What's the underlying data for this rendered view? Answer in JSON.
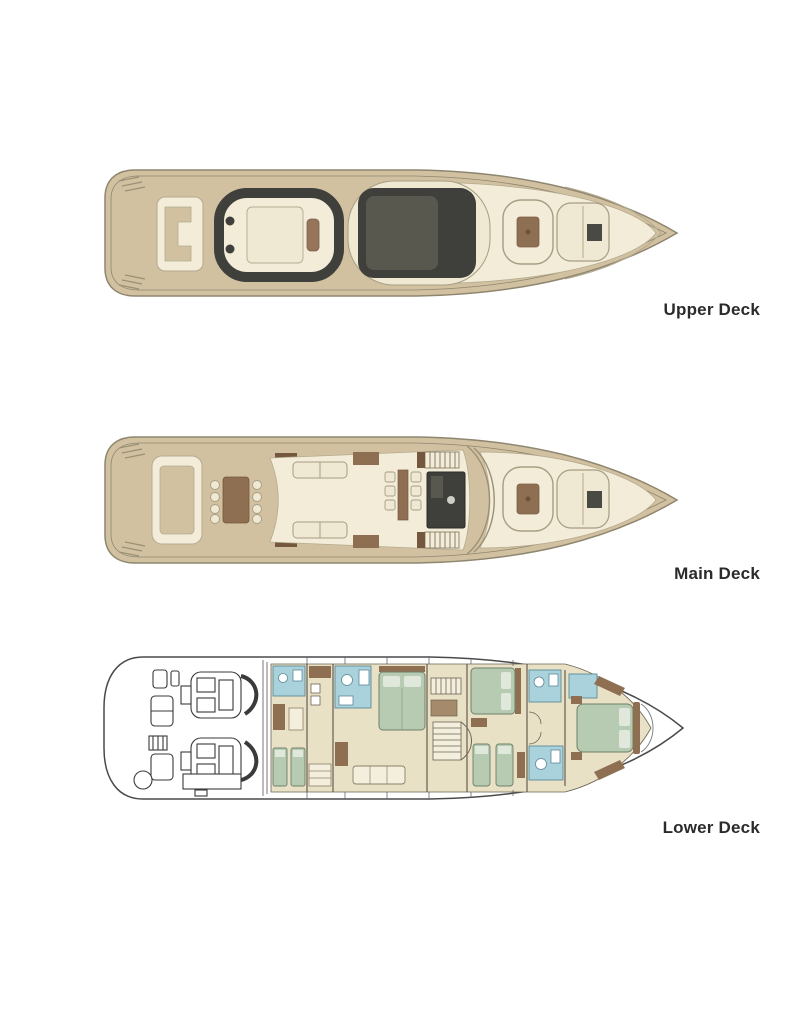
{
  "page": {
    "background": "#ffffff"
  },
  "decks": [
    {
      "id": "upper",
      "label": "Upper Deck"
    },
    {
      "id": "main",
      "label": "Main Deck"
    },
    {
      "id": "lower",
      "label": "Lower Deck"
    }
  ],
  "palette": {
    "hull_tan": "#d1c1a0",
    "hull_outline": "#8f8670",
    "deck_cream": "#f2ecd9",
    "pad_cream": "#efe8d2",
    "dark_gray": "#3f3f3b",
    "mid_gray": "#58584f",
    "wood_brown": "#8f6f52",
    "dark_brown": "#75573f",
    "floor_beige": "#e9e1c6",
    "bed_green": "#b7cbb2",
    "bath_blue": "#a9d2dd",
    "line_dark": "#4a4a4a",
    "label_text": "#2b2b2b"
  }
}
